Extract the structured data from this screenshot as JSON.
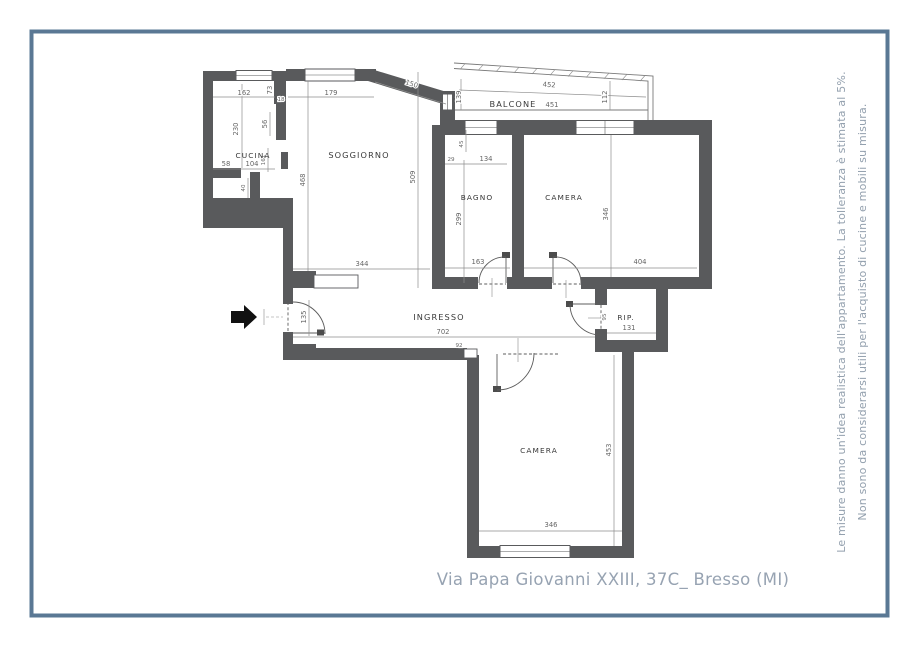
{
  "colors": {
    "frame": "#5a7894",
    "wall": "#595a5c",
    "dimension_text": "#666666",
    "room_text": "#383838",
    "caption_text": "#97a3b2"
  },
  "address": "Via Papa Giovanni XXIII, 37C_ Bresso (MI)",
  "disclaimer": {
    "line1": "Le misure danno un'idea realistica dell'appartamento. La tolleranza è stimata al 5%.",
    "line2": "Non sono da considerarsi utili per l'acquisto di cucine e mobili su misura."
  },
  "rooms": {
    "cucina": "CUCINA",
    "soggiorno": "SOGGIORNO",
    "balcone": "BALCONE",
    "bagno": "BAGNO",
    "camera_top": "CAMERA",
    "ingresso": "INGRESSO",
    "ripostiglio": "RIP.",
    "camera_bottom": "CAMERA"
  },
  "dims": {
    "d162": "162",
    "d73": "73",
    "d179": "179",
    "d150": "150",
    "d452": "452",
    "d451": "451",
    "d139": "139",
    "d112": "112",
    "d230": "230",
    "d56": "56",
    "d18": "18",
    "d58": "58",
    "d104": "104",
    "d161": "161",
    "d40": "40",
    "d468": "468",
    "d509": "509",
    "d344": "344",
    "d29": "29",
    "d134": "134",
    "d45": "45",
    "d299": "299",
    "d163": "163",
    "d404": "404",
    "d346_camera_top": "346",
    "d135": "135",
    "d702": "702",
    "d92": "92",
    "d95": "95",
    "d131": "131",
    "d453": "453",
    "d346_camera_bottom": "346"
  }
}
